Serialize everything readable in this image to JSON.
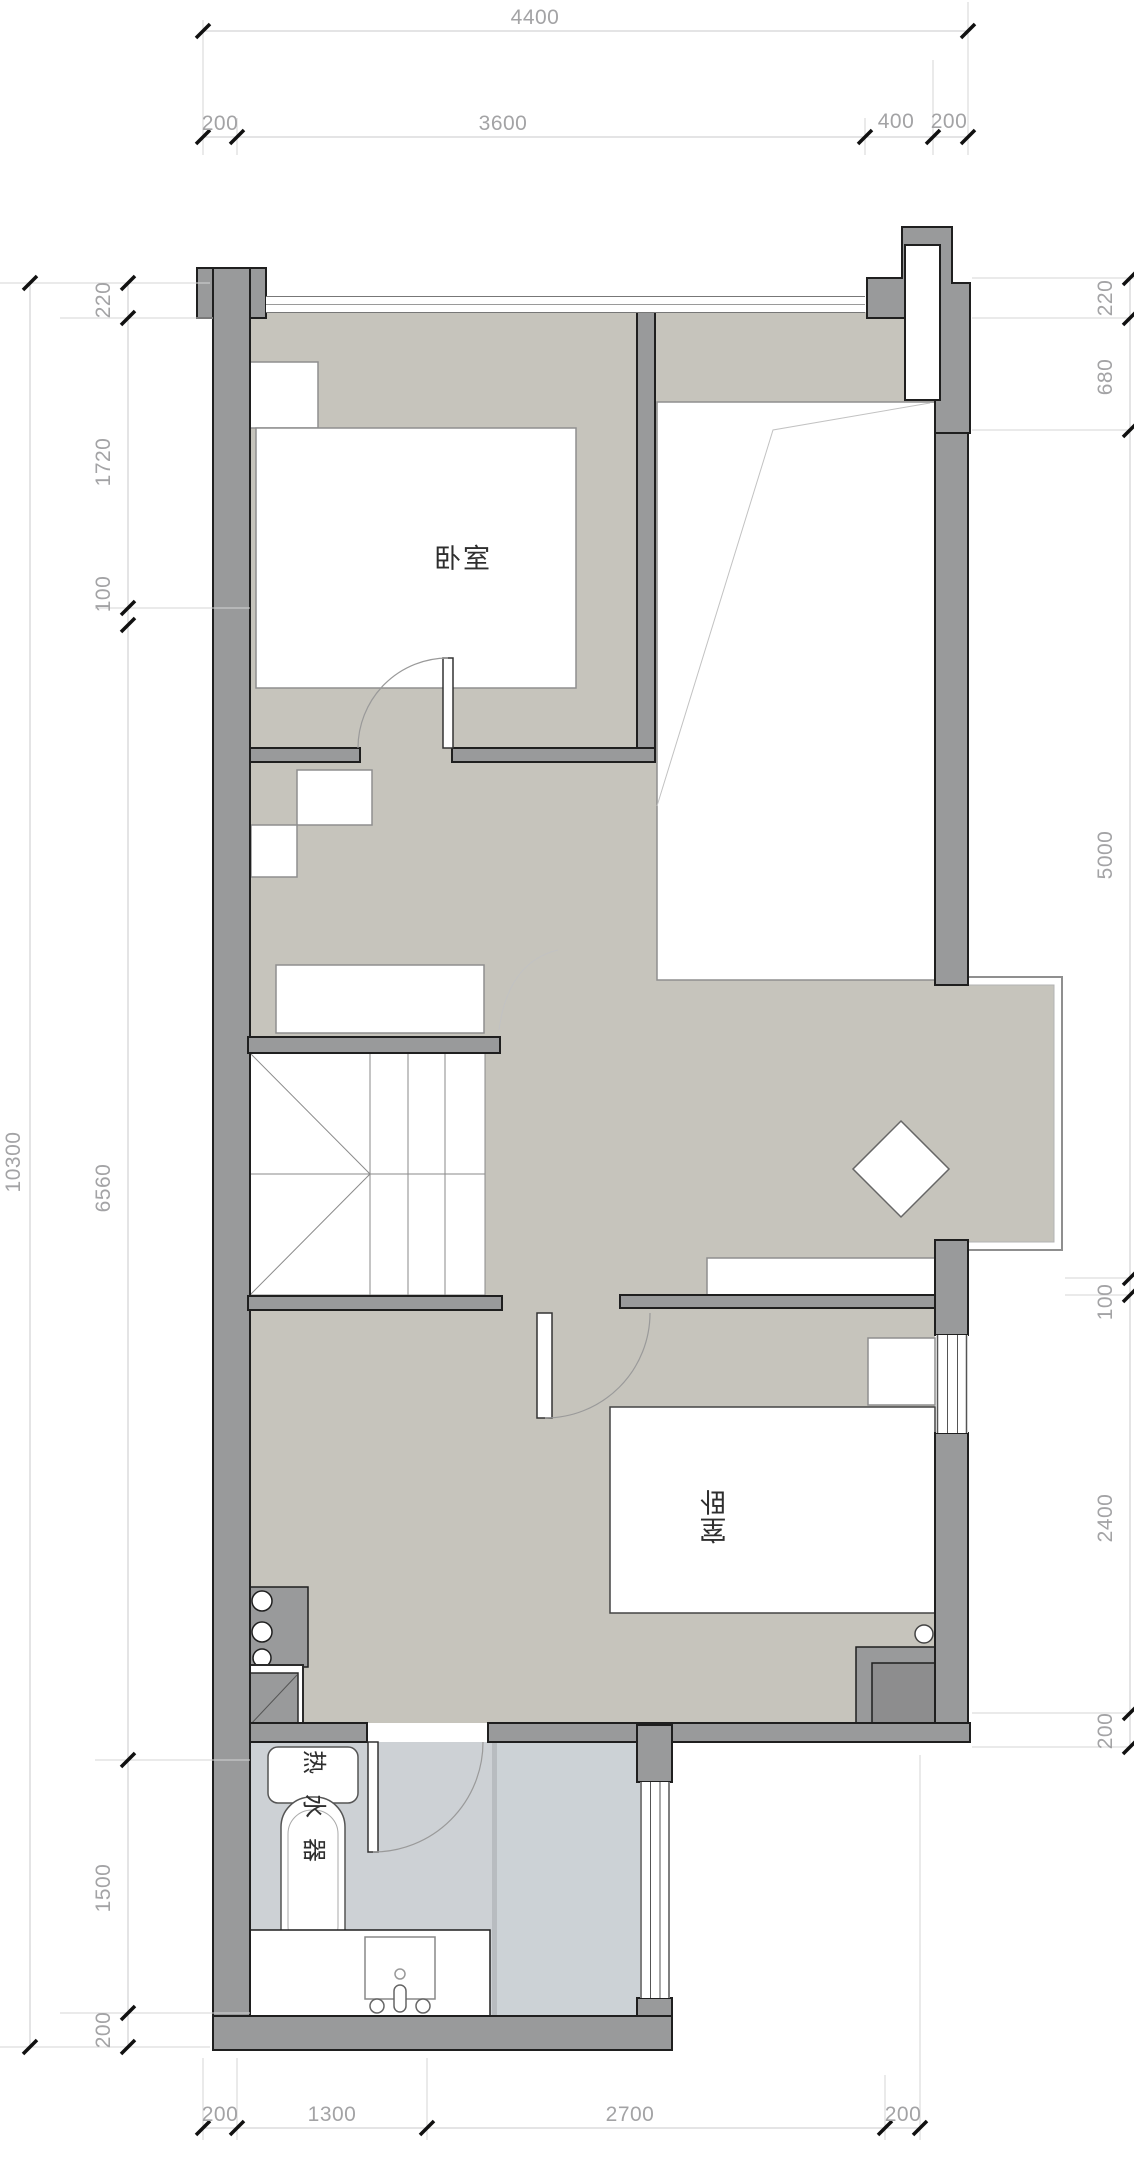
{
  "title": "apartment-floor-plan",
  "colors": {
    "floor": "#c6c4bc",
    "wet_floor": "#cdd1d5",
    "wall": "#999a9b",
    "wall_dark_outline": "#1f1f1f",
    "dim_text": "#a3a3a5",
    "dim_line": "#c9c9cb",
    "furniture_outline": "#8f8f8f"
  },
  "dimensions": {
    "top_total": "4400",
    "top_segments": [
      "200",
      "3600",
      "400",
      "200"
    ],
    "left_total": "10300",
    "left_segments": [
      "220",
      "1720",
      "100",
      "6560",
      "1500",
      "200"
    ],
    "right_segments": [
      "220",
      "680",
      "5000",
      "100",
      "2400",
      "200"
    ],
    "bottom_segments": [
      "200",
      "1300",
      "2700",
      "200"
    ]
  },
  "rooms": {
    "bedroom_top": {
      "label": "卧室"
    },
    "bedroom_bottom": {
      "label": "卧室",
      "chars": [
        "卧",
        "室"
      ]
    },
    "water_heater": {
      "label": "热水器",
      "chars": [
        "热",
        "水",
        "器"
      ]
    }
  }
}
